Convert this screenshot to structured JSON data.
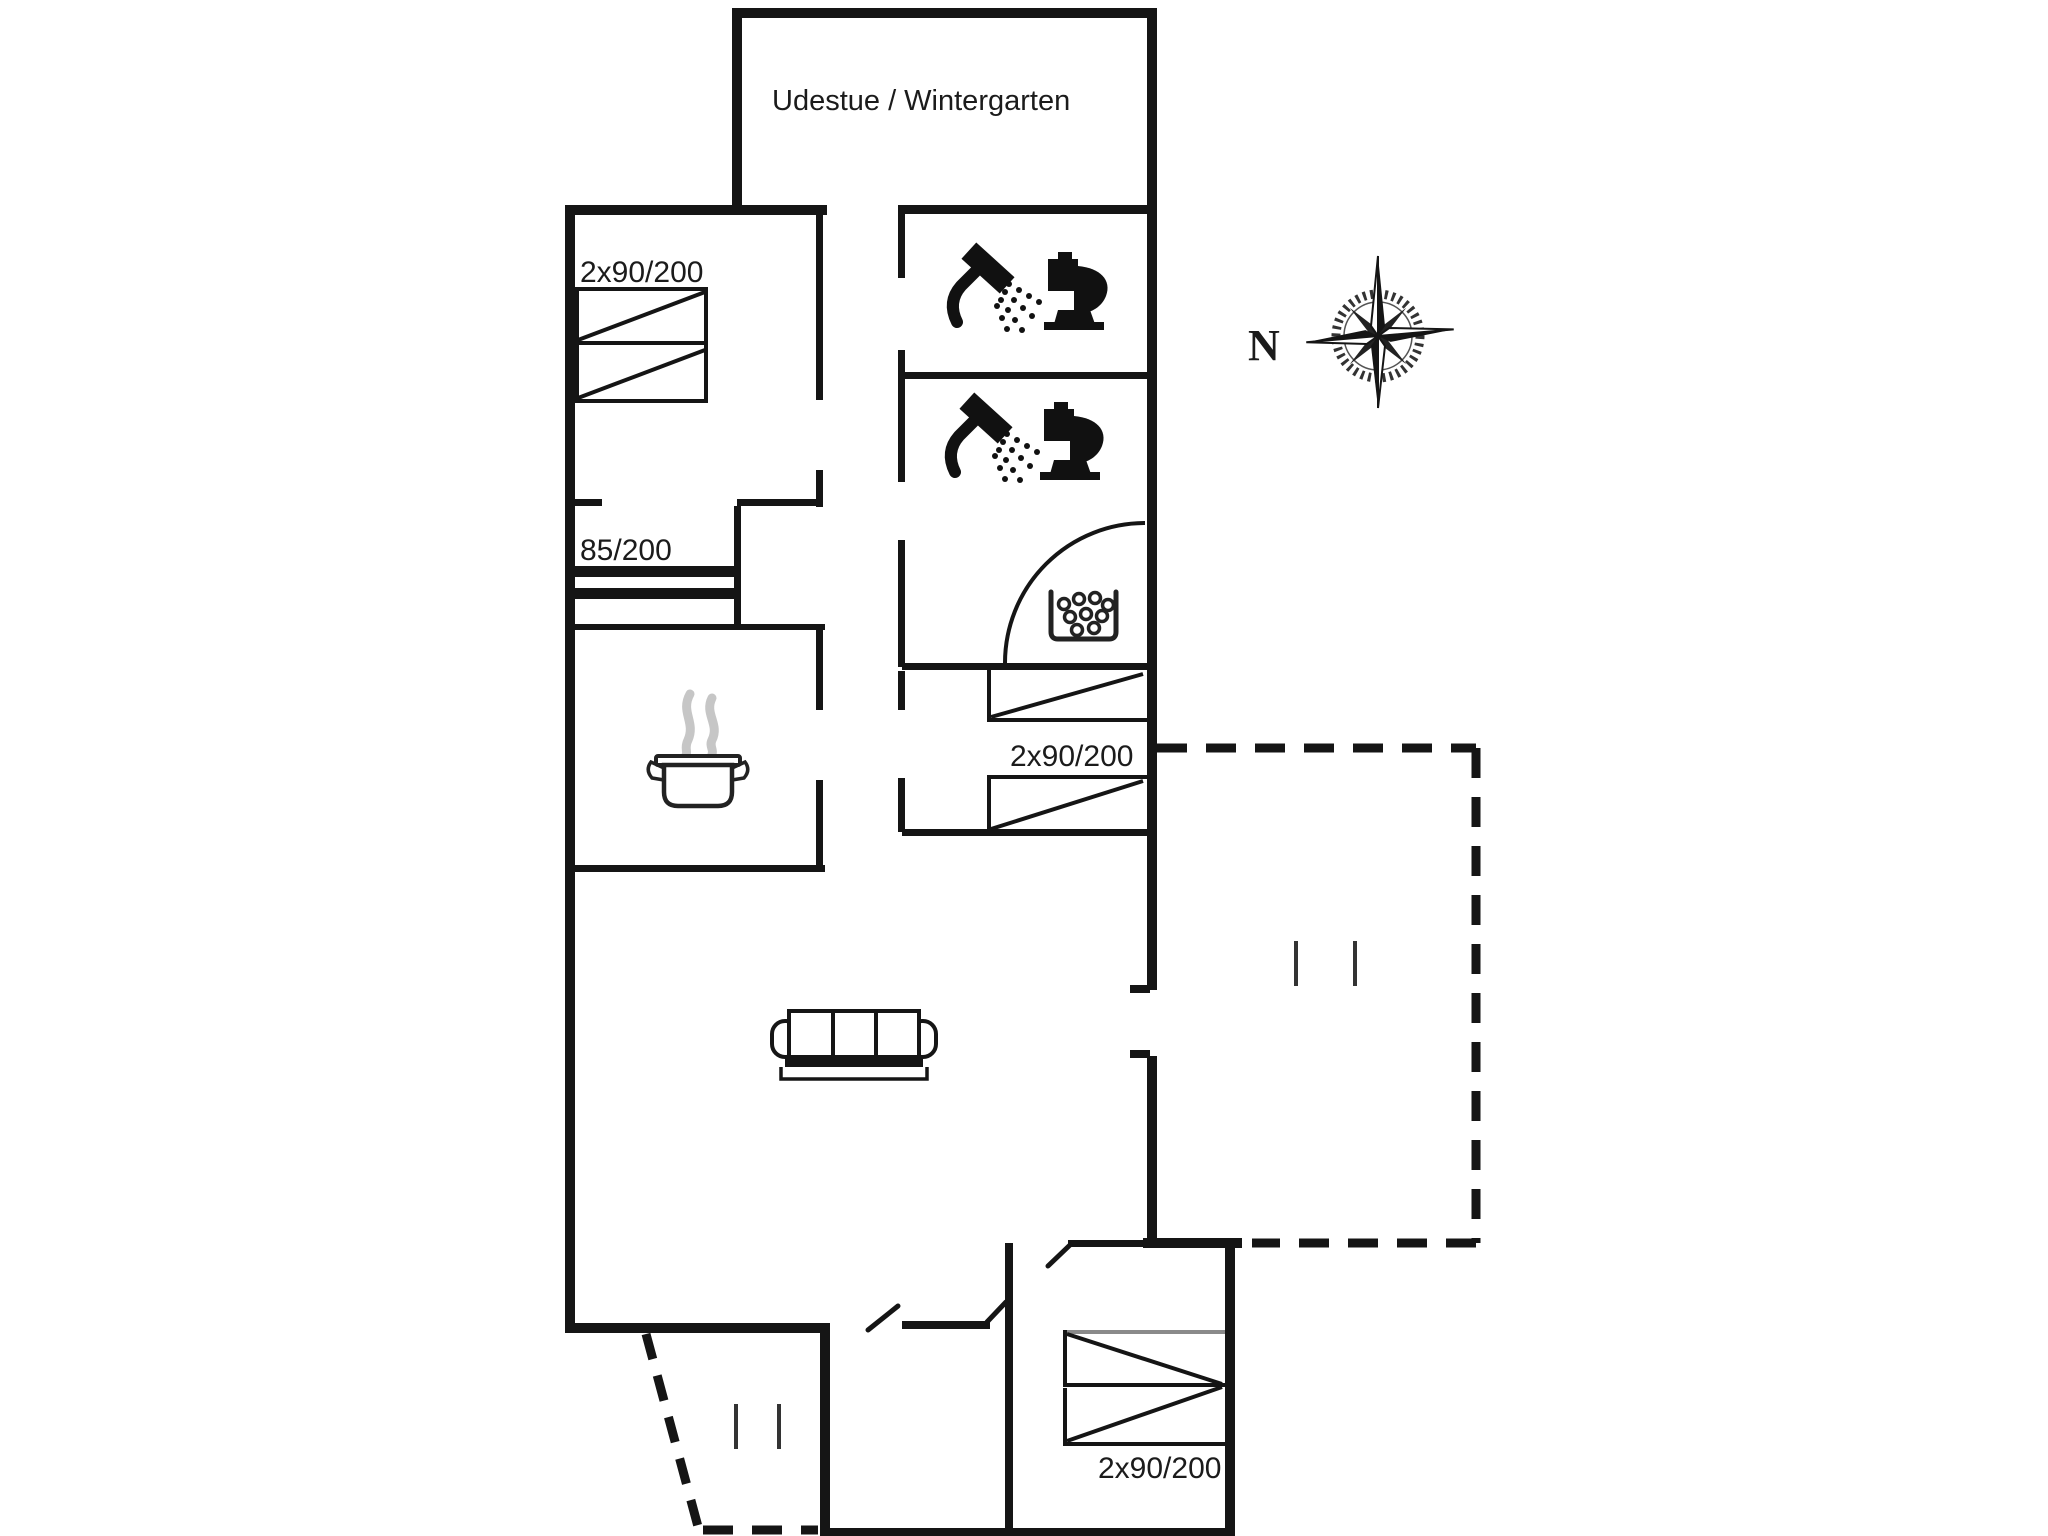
{
  "rooms": {
    "wintergarten": {
      "label": "Udestue / Wintergarten"
    },
    "bedroom_top_left": {
      "bed_size": "2x90/200"
    },
    "bed_alcove": {
      "bed_size": "85/200"
    },
    "bedroom_mid_right": {
      "bed_size": "2x90/200"
    },
    "bedroom_bottom_right": {
      "bed_size": "2x90/200"
    }
  },
  "compass": {
    "north_label": "N"
  },
  "icons": {
    "bathroom_top": [
      "shower-icon",
      "toilet-icon"
    ],
    "bathroom_middle": [
      "shower-icon",
      "toilet-icon"
    ],
    "sauna_room": "sauna-stove-icon",
    "kitchen": "cooking-pot-icon",
    "living_room": "sofa-icon",
    "orientation": "compass-rose-icon"
  },
  "colors": {
    "background": "#ffffff",
    "walls": "#151515",
    "steam_gray": "#c6c6c6",
    "bed_edge_gray": "#8a8a8a"
  }
}
